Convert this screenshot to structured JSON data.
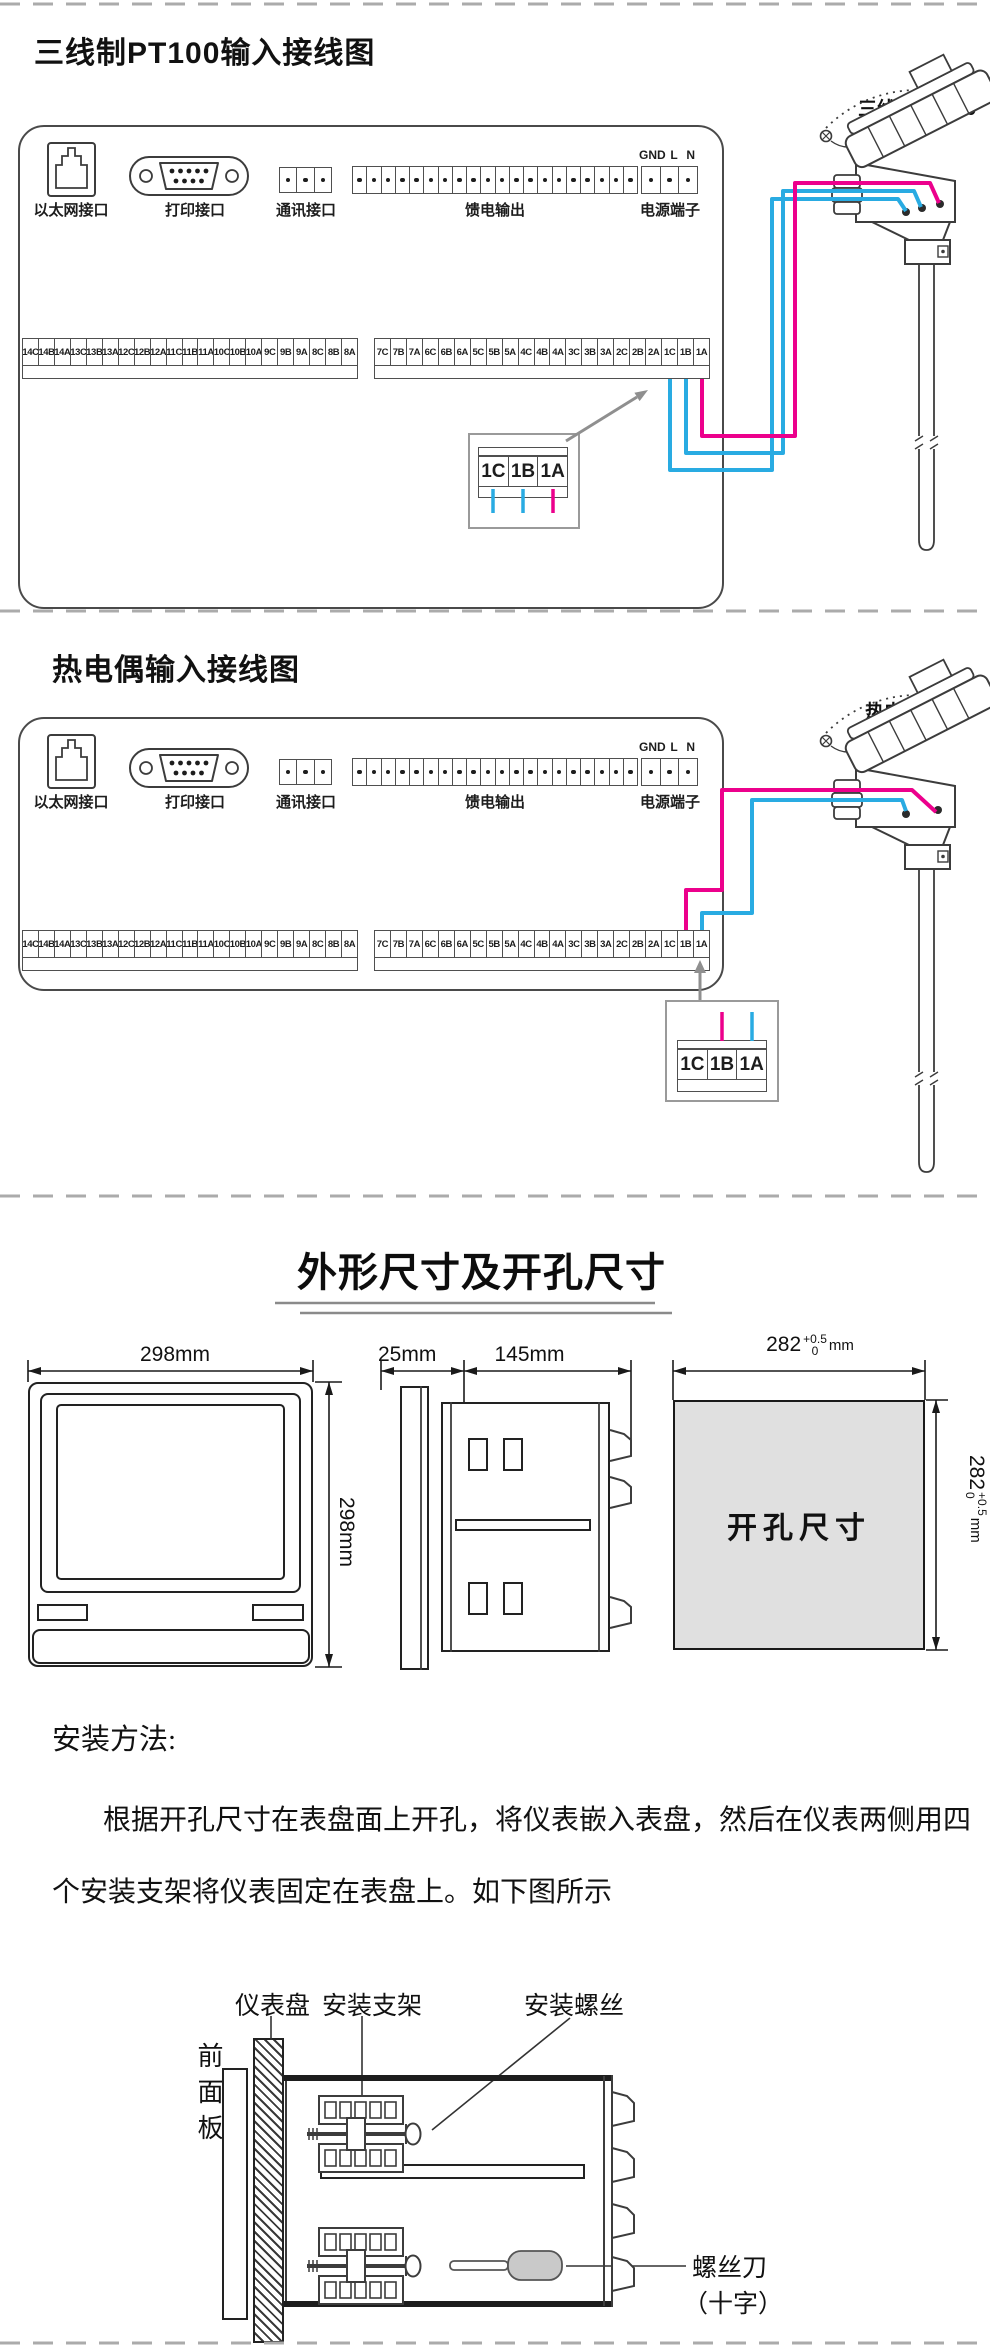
{
  "colors": {
    "wire_pink": "#ec008c",
    "wire_blue": "#29abe2",
    "arrow": "#8f8f8f",
    "ink": "#3c3c3c",
    "callout_border": "#9a9a9a",
    "cutout_fill": "#e0e0e0",
    "handle_fill": "#c9c9c9"
  },
  "section1": {
    "title": "三线制PT100输入接线图",
    "sensor_label": "三线制 PT100",
    "connector_labels": [
      "以太网接口",
      "打印接口",
      "通讯接口",
      "馈电输出",
      "电源端子"
    ],
    "power_pins": [
      "GND",
      "L",
      "N"
    ],
    "strip_left": [
      "14C",
      "14B",
      "14A",
      "13C",
      "13B",
      "13A",
      "12C",
      "12B",
      "12A",
      "11C",
      "11B",
      "11A",
      "10C",
      "10B",
      "10A",
      "9C",
      "9B",
      "9A",
      "8C",
      "8B",
      "8A"
    ],
    "strip_right": [
      "7C",
      "7B",
      "7A",
      "6C",
      "6B",
      "6A",
      "5C",
      "5B",
      "5A",
      "4C",
      "4B",
      "4A",
      "3C",
      "3B",
      "3A",
      "2C",
      "2B",
      "2A",
      "1C",
      "1B",
      "1A"
    ],
    "callout_cells": [
      "1C",
      "1B",
      "1A"
    ]
  },
  "section2": {
    "title": "热电偶输入接线图",
    "sensor_label": "热电偶 TC",
    "connector_labels": [
      "以太网接口",
      "打印接口",
      "通讯接口",
      "馈电输出",
      "电源端子"
    ],
    "power_pins": [
      "GND",
      "L",
      "N"
    ],
    "strip_left": [
      "14C",
      "14B",
      "14A",
      "13C",
      "13B",
      "13A",
      "12C",
      "12B",
      "12A",
      "11C",
      "11B",
      "11A",
      "10C",
      "10B",
      "10A",
      "9C",
      "9B",
      "9A",
      "8C",
      "8B",
      "8A"
    ],
    "strip_right": [
      "7C",
      "7B",
      "7A",
      "6C",
      "6B",
      "6A",
      "5C",
      "5B",
      "5A",
      "4C",
      "4B",
      "4A",
      "3C",
      "3B",
      "3A",
      "2C",
      "2B",
      "2A",
      "1C",
      "1B",
      "1A"
    ],
    "callout_cells": [
      "1C",
      "1B",
      "1A"
    ]
  },
  "section3": {
    "title": "外形尺寸及开孔尺寸",
    "front_width": "298mm",
    "front_height": "298mm",
    "side_bezel": "25mm",
    "side_depth": "145mm",
    "cutout_label": "开孔尺寸",
    "cutout_dim": {
      "value": "282",
      "tol_up": "+0.5",
      "tol_down": "0",
      "unit": "mm"
    }
  },
  "section4": {
    "heading": "安装方法:",
    "para_line1": "根据开孔尺寸在表盘面上开孔，将仪表嵌入表盘，然后在仪表两侧用四",
    "para_line2": "个安装支架将仪表固定在表盘上。如下图所示",
    "label_panel": "仪表盘",
    "label_bracket": "安装支架",
    "label_screw": "安装螺丝",
    "label_front_panel": "前面板",
    "label_screwdriver": "螺丝刀",
    "label_cross": "（十字）"
  }
}
